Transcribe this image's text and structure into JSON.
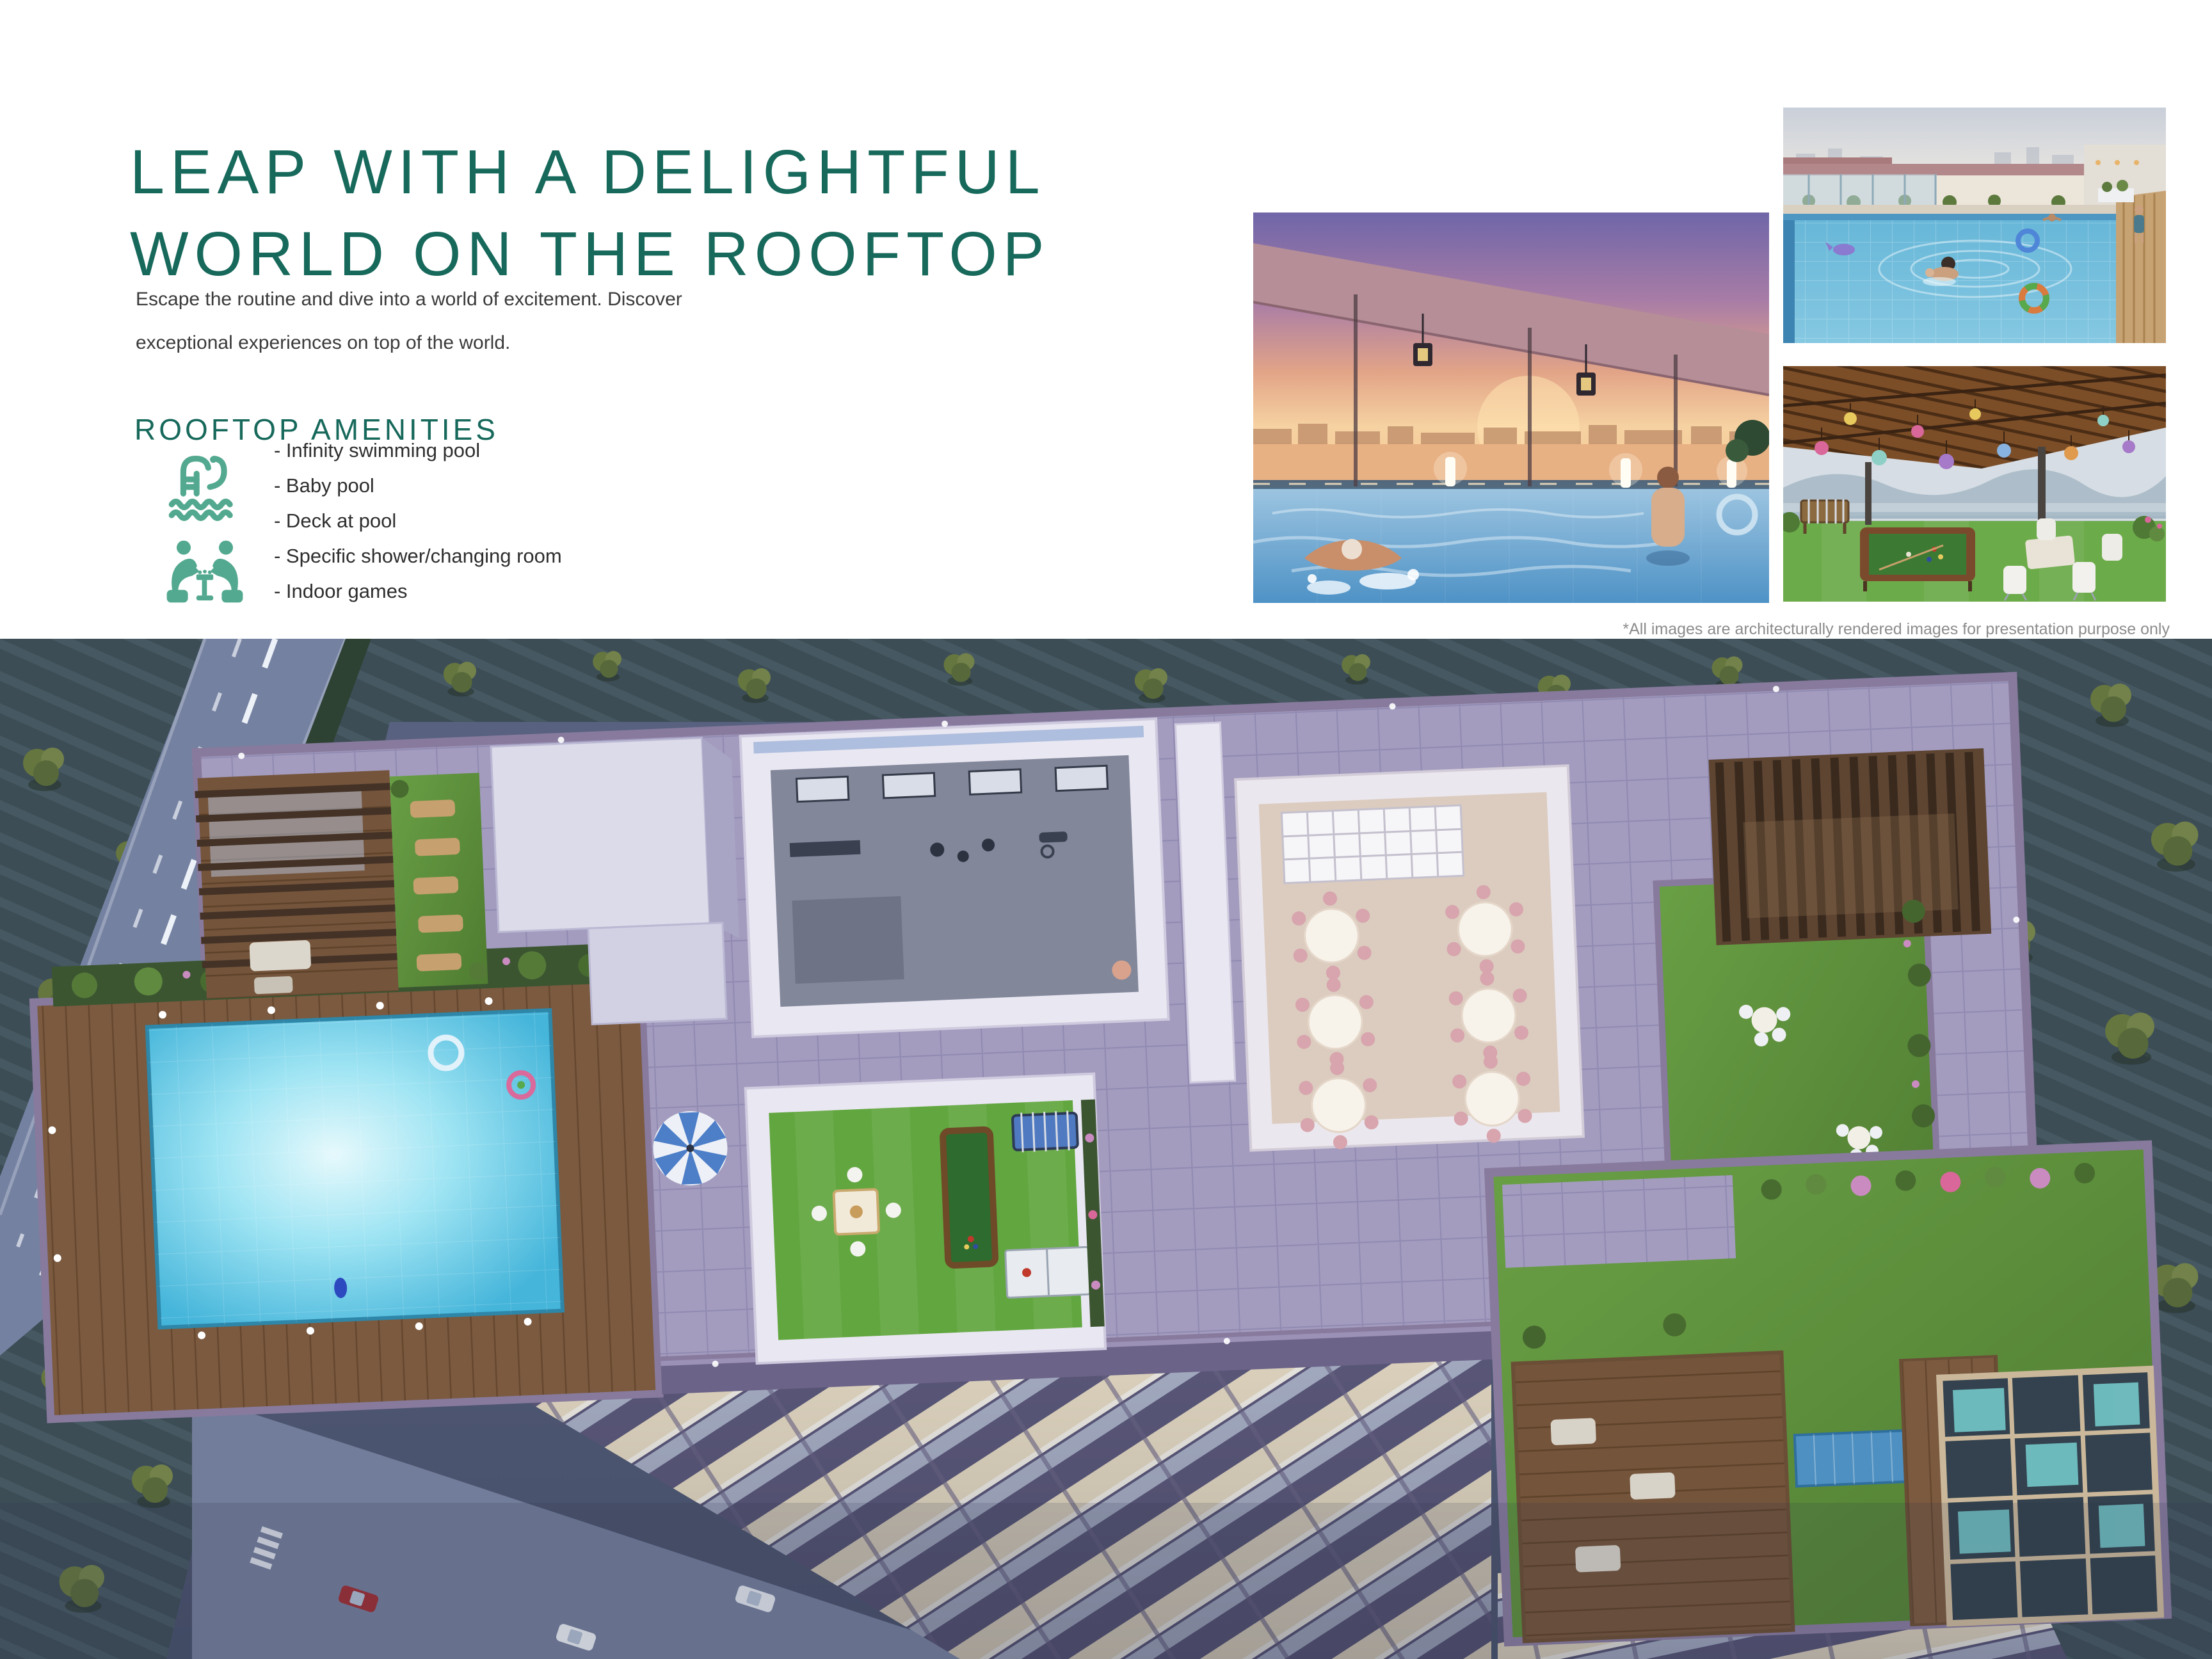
{
  "header": {
    "title_line1": "LEAP WITH A DELIGHTFUL",
    "title_line2": "WORLD ON THE ROOFTOP",
    "intro_line1": "Escape the routine and dive into a world of excitement. Discover",
    "intro_line2": "exceptional experiences on top of the world."
  },
  "amenities": {
    "heading": "ROOFTOP AMENITIES",
    "items": [
      {
        "label": "- Infinity swimming pool"
      },
      {
        "label": "- Baby pool"
      },
      {
        "label": "- Deck at pool"
      },
      {
        "label": "- Specific shower/changing room"
      },
      {
        "label": "- Indoor games"
      }
    ],
    "icons": [
      {
        "name": "swimming-pool-icon"
      },
      {
        "name": "indoor-games-icon"
      }
    ]
  },
  "gallery": {
    "disclaimer": "*All images are architecturally rendered images for presentation purpose only"
  },
  "colors": {
    "accent_teal": "#17695B",
    "icon_teal": "#53A98F",
    "body_text": "#3A3A3A",
    "disclaimer_gray": "#8C8C8C",
    "render_dusk": "#515B76",
    "pool_cyan": "#45B5DA",
    "lawn_green": "#5F9340",
    "parapet_mauve": "#877A9D"
  }
}
